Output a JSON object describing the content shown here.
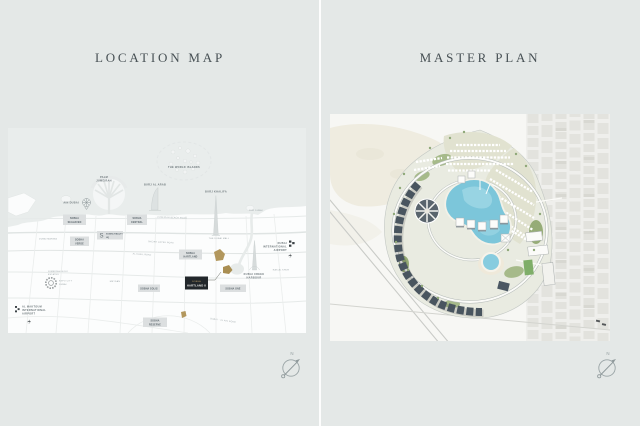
{
  "panels": {
    "left": {
      "title": "LOCATION MAP"
    },
    "right": {
      "title": "MASTER PLAN"
    }
  },
  "compass": {
    "label": "N"
  },
  "location_map": {
    "landmarks": {
      "world_islands": "THE WORLD ISLANDS",
      "palm_line1": "PALM",
      "palm_line2": "JUMEIRAH",
      "ain_dubai": "AIN DUBAI",
      "burj_al_arab": "BURJ AL ARAB",
      "burj_khalifa": "BURJ KHALIFA",
      "dubai_mall": "THE DUBAI MALL",
      "bur_dubai": "BUR DUBAI",
      "ras_al_khor": "RAS AL KHOR",
      "creek_line1": "DUBAI CREEK",
      "creek_line2": "HARBOUR",
      "dxb_line1": "DUBAI",
      "dxb_line2": "INTERNATIONAL",
      "dxb_line3": "AIRPORT",
      "dwc_line1": "AL MAKTOUM",
      "dwc_line2": "INTERNATIONAL",
      "dwc_line3": "AIRPORT",
      "expo_line1": "EXPO CITY",
      "expo_line2": "DUBAI",
      "marina": "DUBAI MARINA",
      "jge_line1": "JUMEIRAH GOLF",
      "jge_line2": "ESTATES",
      "meydan": "MEYDAN"
    },
    "roads": {
      "szr": "SHEIKH ZAYED ROAD",
      "al_khail": "AL KHAIL ROAD",
      "jumeirah_beach": "JUMEIRAH BEACH ROAD",
      "al_ain": "DUBAI - AL AIN ROAD"
    },
    "projects": {
      "seahaven": {
        "l1": "SOBHA",
        "l2": "SEAHAVEN"
      },
      "realty_hq": {
        "logo": "S",
        "l1": "SOBHA REALTY",
        "l2": "HQ"
      },
      "verde": {
        "l1": "SOBHA",
        "l2": "VERDE"
      },
      "central": {
        "l1": "SOBHA",
        "l2": "CENTRAL"
      },
      "solis": {
        "l1": "SOBHA SOLIS"
      },
      "hartland": {
        "l1": "SOBHA",
        "l2": "HARTLAND"
      },
      "hartland2": {
        "l1": "SOBHA",
        "l2": "HARTLAND II",
        "featured": true
      },
      "one": {
        "l1": "SOBHA ONE"
      },
      "reserve": {
        "l1": "SOBHA",
        "l2": "RESERVE"
      }
    },
    "colors": {
      "sea": "#e9edec",
      "land": "#fcfdfd",
      "label_box": "#dcdfe0",
      "label_text": "#59646a",
      "featured_box": "#22272b",
      "featured_text": "#f4f4f2",
      "accent_gold": "#b2975d"
    }
  },
  "master_plan": {
    "features": [
      "central-lagoon",
      "crescent-tower-band",
      "circular-plaza",
      "villa-rows",
      "ring-road",
      "leisure-pool",
      "sports-field",
      "city-grid",
      "desert-sand",
      "highway-diagonals"
    ],
    "colors": {
      "lagoon": "#7cc6da",
      "greenery": "#a6ba8a",
      "towers": "#49555f",
      "sand": "#ece8db",
      "city_blocks": "#e3e3de",
      "background": "#f7f7f4"
    }
  }
}
